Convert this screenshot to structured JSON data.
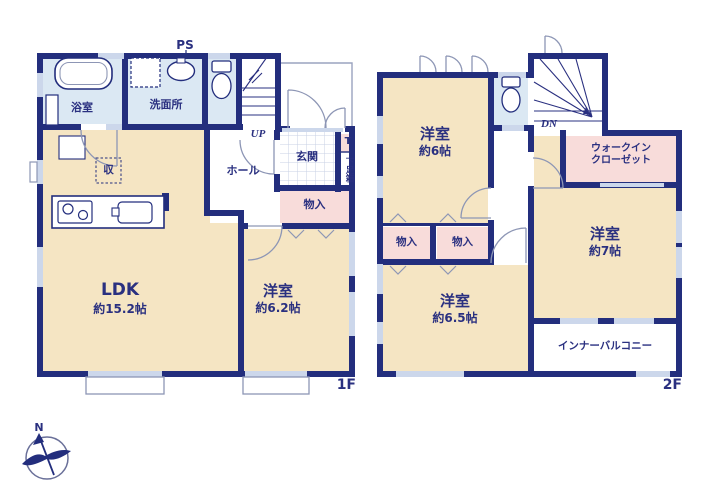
{
  "colors": {
    "wall_navy": "#232e7d",
    "room_beige": "#f5e5c3",
    "wet_blue": "#dbe8f3",
    "closet_pink": "#f8dcda",
    "label_navy": "#2a3080",
    "door_gray": "#8d96b5"
  },
  "floor1": {
    "label": "1F",
    "bathroom": "浴室",
    "washroom": "洗面所",
    "pipe_space": "PS",
    "stairs": "UP",
    "entrance": "玄関",
    "shoe_counter": "T",
    "shoe_box": "下足箱",
    "hall": "ホール",
    "pantry": "収",
    "storage": "物入",
    "ldk_name": "LDK",
    "ldk_size": "約15.2帖",
    "bedroom_name": "洋室",
    "bedroom_size": "約6.2帖"
  },
  "floor2": {
    "label": "2F",
    "stairs": "DN",
    "bedroom6_name": "洋室",
    "bedroom6_size": "約6帖",
    "wic_line1": "ウォークイン",
    "wic_line2": "クローゼット",
    "storage_left": "物入",
    "storage_right": "物入",
    "bedroom65_name": "洋室",
    "bedroom65_size": "約6.5帖",
    "bedroom7_name": "洋室",
    "bedroom7_size": "約7帖",
    "balcony": "インナーバルコニー"
  },
  "compass": {
    "north": "N"
  }
}
